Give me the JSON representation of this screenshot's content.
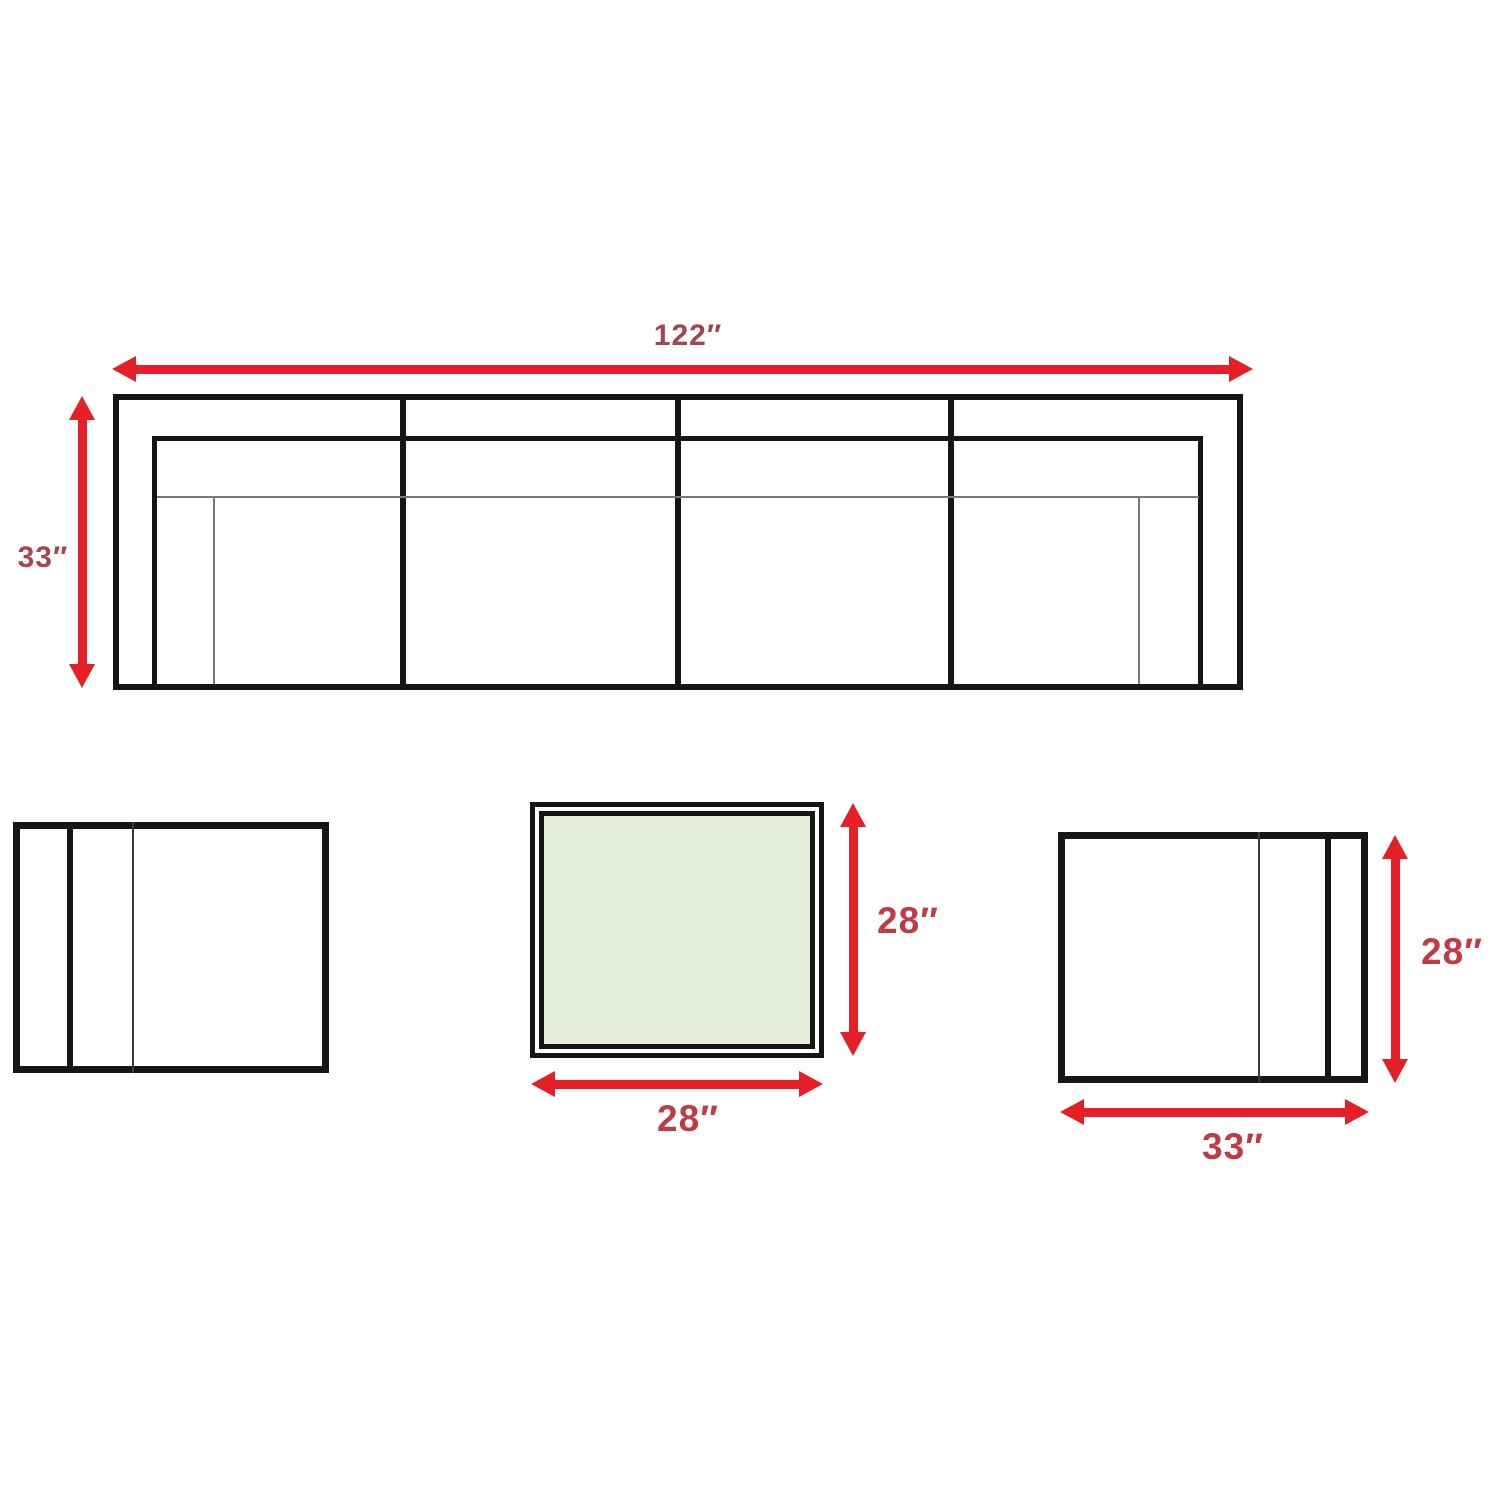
{
  "labels": {
    "sofa": {
      "width": "122″",
      "height": "33″"
    },
    "coffee_table": {
      "width": "28″",
      "height": "28″"
    },
    "right_chair": {
      "width": "33″",
      "height": "28″"
    }
  },
  "colors": {
    "arrow_red": "#e61e26",
    "sofa_label_red": "#a4454f",
    "bottom_label_red": "#c03b44",
    "outline_black": "#161616",
    "thin_line_gray": "#787878",
    "table_fill_green": "#e3edd9",
    "background": "#ffffff"
  }
}
